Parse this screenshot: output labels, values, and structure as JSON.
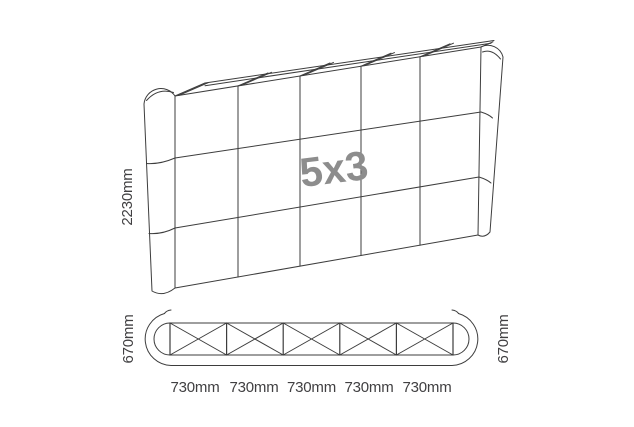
{
  "front_view": {
    "size_label": "5x3",
    "height_label": "2230mm",
    "columns": 5,
    "rows": 3
  },
  "plan_view": {
    "sections": 5,
    "depth_label_left": "670mm",
    "depth_label_right": "670mm",
    "section_width_labels": [
      "730mm",
      "730mm",
      "730mm",
      "730mm",
      "730mm"
    ]
  },
  "colors": {
    "line": "#3d3d3d",
    "dimension_text": "#414042",
    "size_label_text": "#8d8d8d",
    "background": "#ffffff"
  }
}
